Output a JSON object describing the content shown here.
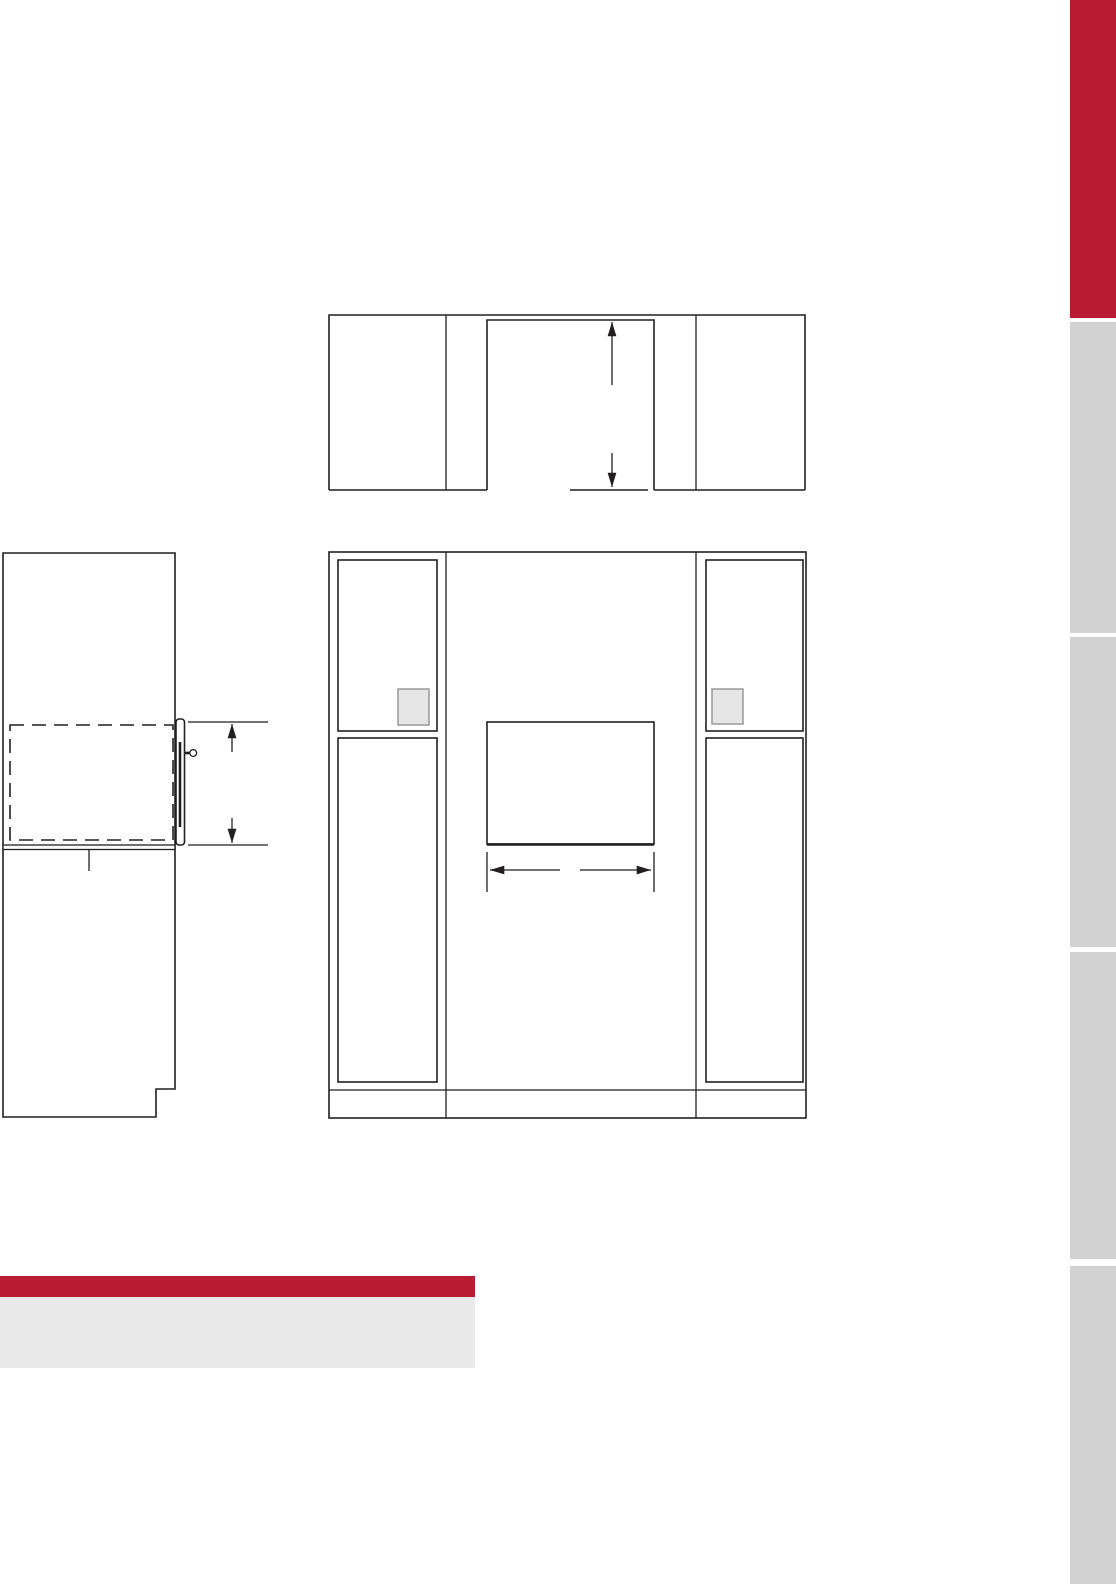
{
  "page": {
    "kind": "appliance-installation-spec-sheet-page",
    "background": "#ffffff",
    "width_px": 1116,
    "height_px": 1584
  },
  "colors": {
    "brand_red": "#b91c33",
    "tab_gray": "#d2d2d2",
    "footer_block_gray": "#e9e9e9",
    "line": "#231f20",
    "outlet_fill": "#e5e5e5",
    "outlet_border": "#999999"
  },
  "side_tabs": {
    "items": [
      {
        "id": "tab-1",
        "active": true,
        "color": "#b91c33"
      },
      {
        "id": "tab-2",
        "active": false,
        "color": "#d2d2d2"
      },
      {
        "id": "tab-3",
        "active": false,
        "color": "#d2d2d2"
      },
      {
        "id": "tab-4",
        "active": false,
        "color": "#d2d2d2"
      },
      {
        "id": "tab-5",
        "active": false,
        "color": "#d2d2d2"
      }
    ]
  },
  "footer": {
    "heading_bar_color": "#b91c33",
    "note_block_color": "#e9e9e9"
  },
  "diagrams": {
    "plan_view": {
      "name": "top-view-opening-with-vertical-dimension-arrow"
    },
    "side_view": {
      "name": "side-section-view-cabinet-with-drawer-and-height-dimension"
    },
    "front_view": {
      "name": "front-elevation-cabinet-with-cutout-and-width-dimension"
    }
  }
}
